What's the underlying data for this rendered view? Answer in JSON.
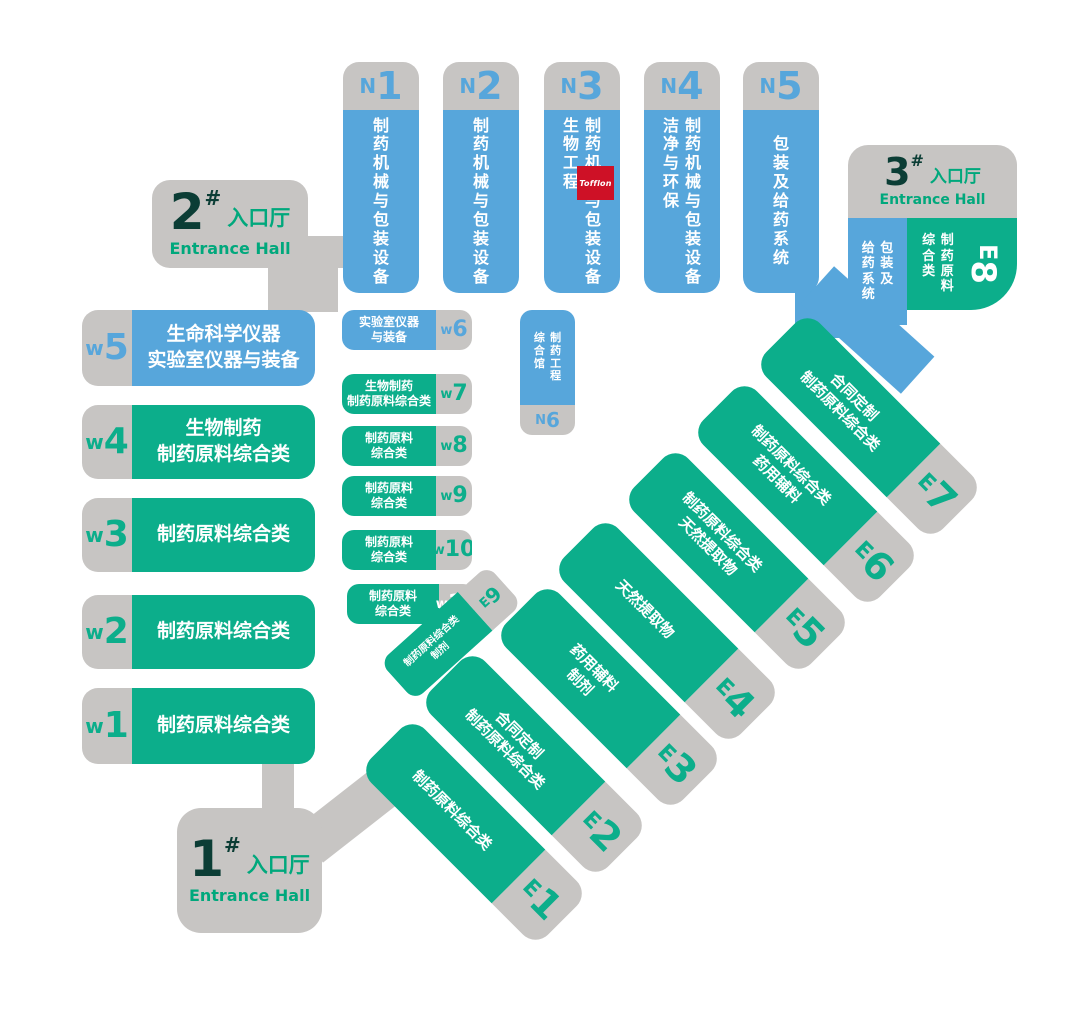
{
  "colors": {
    "hall_blue": "#57a6db",
    "hall_green": "#0cae8b",
    "corridor_gray": "#c7c5c3",
    "entrance_number_dark": "#0b3d35",
    "entrance_text_green": "#00a87c",
    "logo_red": "#ce1126",
    "background": "#ffffff"
  },
  "north_halls": [
    {
      "prefix": "N",
      "num": "1",
      "lines": [
        "制药机械与包装设备"
      ]
    },
    {
      "prefix": "N",
      "num": "2",
      "lines": [
        "制药机械与包装设备"
      ]
    },
    {
      "prefix": "N",
      "num": "3",
      "lines": [
        "制药机械与包装设备",
        "生物工程"
      ]
    },
    {
      "prefix": "N",
      "num": "4",
      "lines": [
        "制药机械与包装设备",
        "洁净与环保"
      ]
    },
    {
      "prefix": "N",
      "num": "5",
      "lines": [
        "包装及给药系统"
      ]
    }
  ],
  "west_halls": [
    {
      "prefix": "w",
      "num": "5",
      "lines": [
        "生命科学仪器",
        "实验室仪器与装备"
      ]
    },
    {
      "prefix": "w",
      "num": "4",
      "lines": [
        "生物制药",
        "制药原料综合类"
      ]
    },
    {
      "prefix": "w",
      "num": "3",
      "lines": [
        "制药原料综合类"
      ]
    },
    {
      "prefix": "w",
      "num": "2",
      "lines": [
        "制药原料综合类"
      ]
    },
    {
      "prefix": "w",
      "num": "1",
      "lines": [
        "制药原料综合类"
      ]
    }
  ],
  "west_small_halls": [
    {
      "prefix": "w",
      "num": "6",
      "lines": [
        "实验室仪器",
        "与装备"
      ]
    },
    {
      "prefix": "w",
      "num": "7",
      "lines": [
        "生物制药",
        "制药原料综合类"
      ]
    },
    {
      "prefix": "w",
      "num": "8",
      "lines": [
        "制药原料",
        "综合类"
      ]
    },
    {
      "prefix": "w",
      "num": "9",
      "lines": [
        "制药原料",
        "综合类"
      ]
    },
    {
      "prefix": "w",
      "num": "10",
      "lines": [
        "制药原料",
        "综合类"
      ]
    },
    {
      "prefix": "w",
      "num": "11",
      "lines": [
        "制药原料",
        "综合类"
      ]
    }
  ],
  "n6_hall": {
    "prefix": "N",
    "num": "6",
    "lines": [
      "制药工程",
      "综合馆"
    ]
  },
  "east_halls": [
    {
      "prefix": "E",
      "num": "1",
      "lines": [
        "制药原料综合类"
      ]
    },
    {
      "prefix": "E",
      "num": "2",
      "lines": [
        "合同定制",
        "制药原料综合类"
      ]
    },
    {
      "prefix": "E",
      "num": "3",
      "lines": [
        "药用辅料",
        "制剂"
      ]
    },
    {
      "prefix": "E",
      "num": "4",
      "lines": [
        "天然提取物"
      ]
    },
    {
      "prefix": "E",
      "num": "5",
      "lines": [
        "制药原料综合类",
        "天然提取物"
      ]
    },
    {
      "prefix": "E",
      "num": "6",
      "lines": [
        "制药原料综合类",
        "药用辅料"
      ]
    },
    {
      "prefix": "E",
      "num": "7",
      "lines": [
        "合同定制",
        "制药原料综合类"
      ]
    }
  ],
  "e9_hall": {
    "prefix": "E",
    "num": "9",
    "lines": [
      "制药原料综合类",
      "制剂"
    ]
  },
  "e8_hall": {
    "prefix": "E",
    "num": "8",
    "blue_lines": [
      "包装及",
      "给药系统"
    ],
    "green_lines": [
      "制药原料",
      "综合类"
    ]
  },
  "entrances": {
    "one": {
      "num": "1",
      "hash": "#",
      "cn": "入口厅",
      "en": "Entrance Hall"
    },
    "two": {
      "num": "2",
      "hash": "#",
      "cn": "入口厅",
      "en": "Entrance Hall"
    },
    "three": {
      "num": "3",
      "hash": "#",
      "cn": "入口厅",
      "en": "Entrance Hall"
    }
  },
  "logo": {
    "text": "Tofflon"
  }
}
